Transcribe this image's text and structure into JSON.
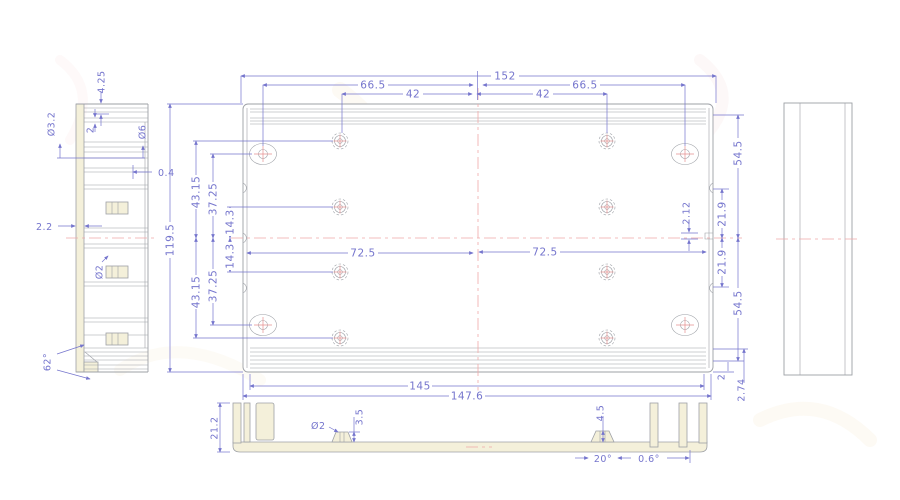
{
  "title": "extrusion-enclosure-engineering-drawing",
  "colors": {
    "background": "#ffffff",
    "dimension": "#7575cd",
    "outline": "#9da0a6",
    "profile_fill": "#f4f0da",
    "centerline": "#f0a8a8",
    "hole_mark": "#e58f8f",
    "watermark_gold": "#e0b04a",
    "watermark_red": "#d97070"
  },
  "views": {
    "side_left": {
      "dims": {
        "d4_25": "4.25",
        "d2": "2",
        "dia3_2": "Ø3.2",
        "dia6": "Ø6",
        "d0_4": "0.4",
        "d2_2": "2.2",
        "dia2": "Ø2",
        "a62": "62°"
      }
    },
    "plan": {
      "dims": {
        "w152": "152",
        "w66_5l": "66.5",
        "w42l": "42",
        "w42r": "42",
        "w66_5r": "66.5",
        "h119_5": "119.5",
        "h43_15t": "43.15",
        "h37_25t": "37.25",
        "h14_3t": "14.3",
        "h14_3b": "14.3",
        "h37_25b": "37.25",
        "h43_15b": "43.15",
        "w72_5l": "72.5",
        "w72_5r": "72.5",
        "d2_12": "2.12",
        "h54_5t": "54.5",
        "h21_9t": "21.9",
        "h21_9b": "21.9",
        "h54_5b": "54.5",
        "d2r": "2",
        "d2_74": "2.74",
        "w145": "145",
        "w147_6": "147.6"
      }
    },
    "bottom": {
      "dims": {
        "h21_2": "21.2",
        "dia2": "Ø2",
        "d3_5": "3.5",
        "d4_5": "4.5",
        "a20": "20°",
        "a0_6": "0.6°"
      }
    }
  }
}
